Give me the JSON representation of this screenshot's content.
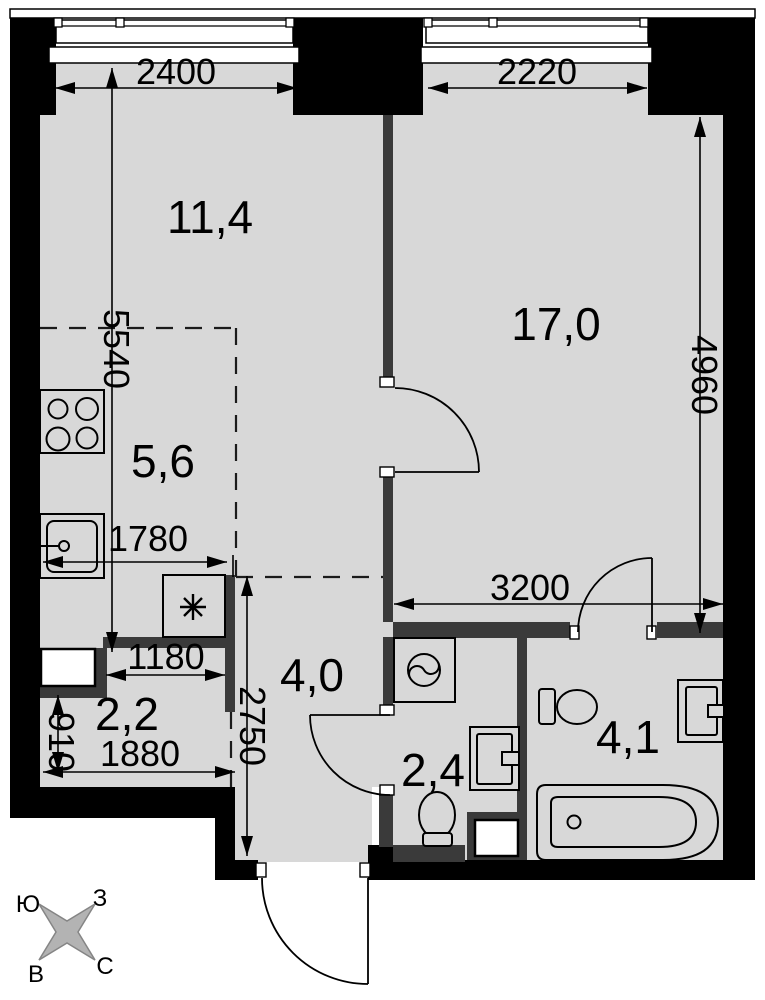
{
  "document": {
    "type": "apartment floor plan",
    "units": "mm"
  },
  "rooms": [
    {
      "id": "living-room",
      "area": "11,4"
    },
    {
      "id": "bedroom",
      "area": "17,0"
    },
    {
      "id": "kitchen-zone",
      "area": "5,6"
    },
    {
      "id": "hallway",
      "area": "4,0"
    },
    {
      "id": "storage",
      "area": "2,2"
    },
    {
      "id": "wc",
      "area": "2,4"
    },
    {
      "id": "bathroom",
      "area": "4,1"
    }
  ],
  "dimensions": {
    "window_left": "2400",
    "window_right": "2220",
    "left_height": "5540",
    "right_height": "4960",
    "kitchen_zone_width": "1780",
    "lower_width": "3200",
    "storage_niche_width": "1180",
    "hallway_height": "2750",
    "storage_height": "910",
    "storage_width": "1880"
  },
  "compass": {
    "top_left": "Ю",
    "top_right": "З",
    "bottom_left": "В",
    "bottom_right": "С"
  },
  "colors": {
    "floor": "#d8d8d8",
    "exterior_wall": "#000000",
    "interior_wall": "#3a3a3a",
    "line": "#000000",
    "compass_star": "#b3b3b3"
  },
  "icons": {
    "stove": "stove-burners-icon",
    "kitchen_sink": "kitchen-sink-icon",
    "storage_marker": "asterisk-snowflake-icon",
    "washing_machine": "washing-machine-icon",
    "wc_sink": "washbasin-icon",
    "wc_toilet": "toilet-icon",
    "bathroom_sink": "washbasin-icon",
    "bathroom_toilet": "toilet-icon",
    "bathtub": "bathtub-icon",
    "compass": "compass-rose-icon"
  }
}
